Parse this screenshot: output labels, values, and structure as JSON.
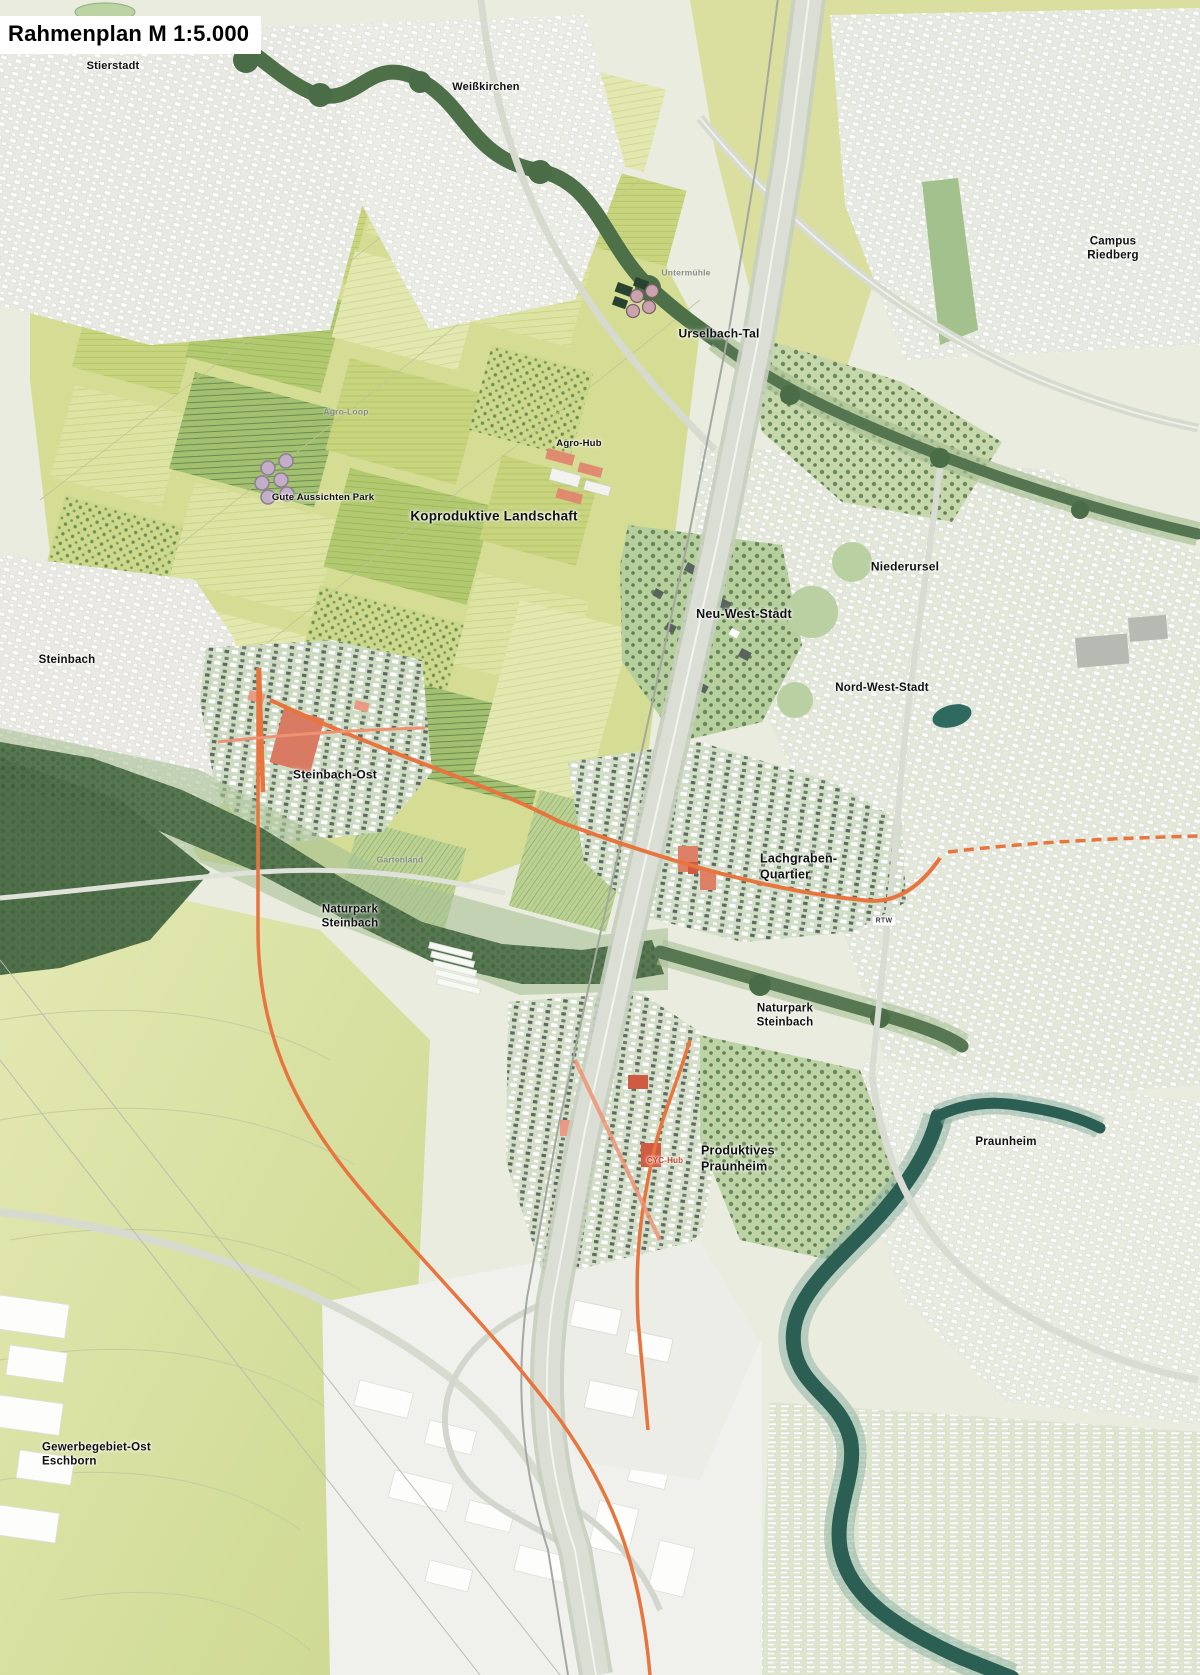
{
  "meta": {
    "kind": "urban-masterplan-map",
    "region": "Frankfurt Nordwest / Steinbach"
  },
  "title": {
    "text": "Rahmenplan M 1:5.000"
  },
  "palette": {
    "field_yellow": "#c9d47f",
    "field_green": "#b2c96f",
    "field_pale": "#e3e7b0",
    "urban_light": "#e9e9e3",
    "urban_sage": "#e3e8da",
    "quarter_green": "#cddcc1",
    "park_green": "#b6cf9d",
    "forest_dark": "#56774f",
    "water_teal": "#2c5f54",
    "road_orange": "#e8743e",
    "accent_salmon": "#e89b82",
    "accent_red": "#d05a42",
    "building_white": "#ffffff",
    "building_dark": "#59645e"
  },
  "labels": [
    {
      "id": "stierstadt",
      "text": "Stierstadt",
      "x": 113,
      "y": 67,
      "size": 11,
      "tier": "major"
    },
    {
      "id": "weisskirchen",
      "text": "Weißkirchen",
      "x": 486,
      "y": 88,
      "size": 11,
      "tier": "major"
    },
    {
      "id": "campus-riedberg",
      "text": "Campus Riedberg",
      "x": 1113,
      "y": 249,
      "size": 11.5,
      "tier": "major"
    },
    {
      "id": "urselbach-tal",
      "text": "Urselbach-Tal",
      "x": 719,
      "y": 334,
      "size": 12,
      "tier": "major"
    },
    {
      "id": "untermuehle",
      "text": "Untermühle",
      "x": 686,
      "y": 273,
      "size": 8.5,
      "tier": "minor"
    },
    {
      "id": "agro-loop",
      "text": "Agro-Loop",
      "x": 346,
      "y": 412,
      "size": 8.5,
      "tier": "minor"
    },
    {
      "id": "agro-hub",
      "text": "Agro-Hub",
      "x": 579,
      "y": 444,
      "size": 9.5,
      "tier": "major"
    },
    {
      "id": "gute-aussichten-park",
      "text": "Gute Aussichten Park",
      "x": 323,
      "y": 498,
      "size": 9.5,
      "tier": "major"
    },
    {
      "id": "koproduktive-landschaft",
      "text": "Koproduktive Landschaft",
      "x": 494,
      "y": 517,
      "size": 13.5,
      "tier": "major"
    },
    {
      "id": "niederursel",
      "text": "Niederursel",
      "x": 905,
      "y": 567,
      "size": 12,
      "tier": "major"
    },
    {
      "id": "neu-west-stadt",
      "text": "Neu-West-Stadt",
      "x": 744,
      "y": 615,
      "size": 12.5,
      "tier": "major"
    },
    {
      "id": "nord-west-stadt",
      "text": "Nord-West-Stadt",
      "x": 882,
      "y": 688,
      "size": 11.5,
      "tier": "major"
    },
    {
      "id": "steinbach",
      "text": "Steinbach",
      "x": 67,
      "y": 660,
      "size": 11.5,
      "tier": "major"
    },
    {
      "id": "steinbach-ost",
      "text": "Steinbach-Ost",
      "x": 335,
      "y": 775,
      "size": 12,
      "tier": "major"
    },
    {
      "id": "gartenland",
      "text": "Gartenland",
      "x": 400,
      "y": 860,
      "size": 8.5,
      "tier": "minor"
    },
    {
      "id": "lachgraben-quartier",
      "text": "Lachgraben-\nQuartier",
      "x": 760,
      "y": 867,
      "size": 12.5,
      "tier": "major",
      "align": "left"
    },
    {
      "id": "naturpark-steinbach-1",
      "text": "Naturpark\nSteinbach",
      "x": 350,
      "y": 917,
      "size": 11.5,
      "tier": "major"
    },
    {
      "id": "naturpark-steinbach-2",
      "text": "Naturpark\nSteinbach",
      "x": 785,
      "y": 1016,
      "size": 11.5,
      "tier": "major"
    },
    {
      "id": "produktives-praunheim",
      "text": "Produktives\nPraunheim",
      "x": 701,
      "y": 1159,
      "size": 12.5,
      "tier": "major",
      "align": "left"
    },
    {
      "id": "cyc-hub",
      "text": "CYC-Hub",
      "x": 665,
      "y": 1161,
      "size": 8,
      "tier": "red"
    },
    {
      "id": "praunheim",
      "text": "Praunheim",
      "x": 1006,
      "y": 1142,
      "size": 11.5,
      "tier": "major"
    },
    {
      "id": "gewerbegebiet-ost-eschborn",
      "text": "Gewerbegebiet-Ost\nEschborn",
      "x": 42,
      "y": 1455,
      "size": 11.5,
      "tier": "major",
      "align": "left"
    }
  ],
  "badges": [
    {
      "id": "rtw",
      "text": "RTW",
      "x": 884,
      "y": 921
    }
  ]
}
